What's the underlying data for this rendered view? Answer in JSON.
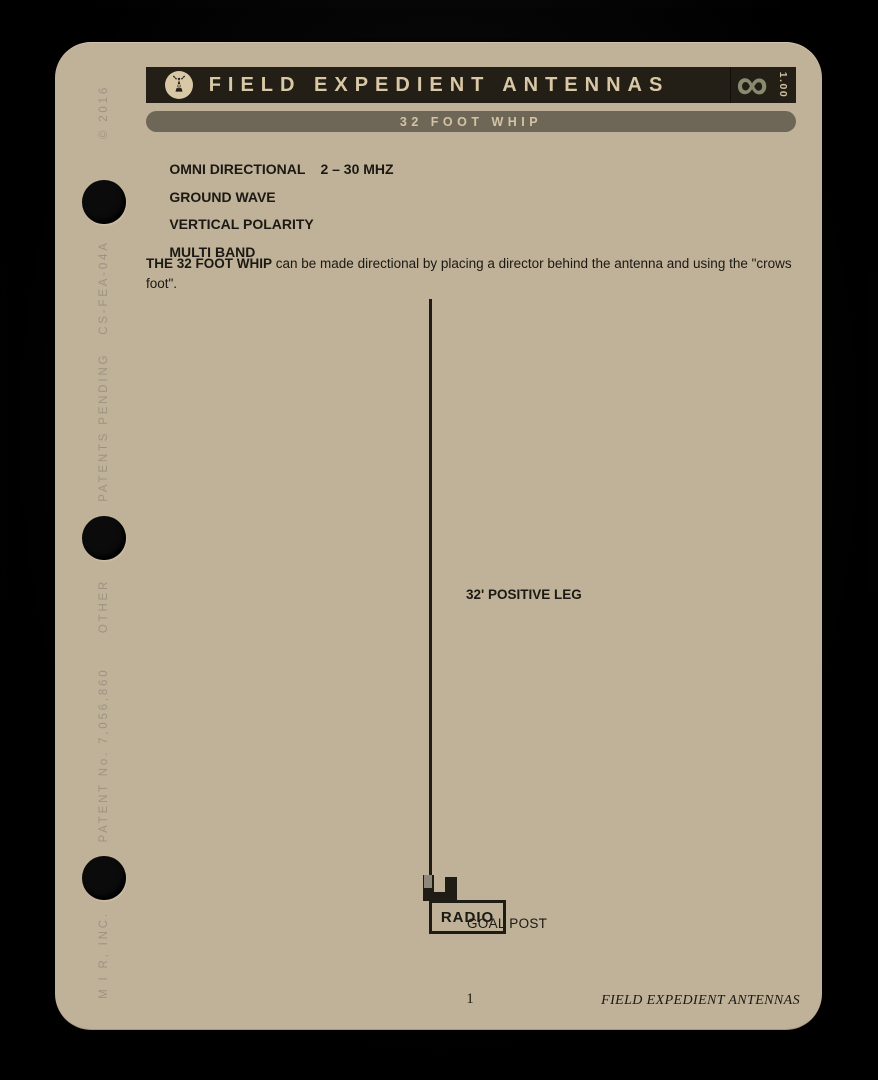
{
  "header": {
    "title": "FIELD EXPEDIENT ANTENNAS",
    "subtitle": "32 FOOT WHIP",
    "version": "1.00",
    "infinity": "∞"
  },
  "specs": [
    {
      "label": "OMNI DIRECTIONAL",
      "value": "2 – 30 MHZ"
    },
    {
      "label": "GROUND WAVE",
      "value": ""
    },
    {
      "label": "VERTICAL POLARITY",
      "value": ""
    },
    {
      "label": "MULTI BAND",
      "value": ""
    }
  ],
  "description": {
    "lead": "THE 32 FOOT WHIP",
    "body": " can be made directional by placing a director behind the antenna and using the \"crows foot\"."
  },
  "diagram": {
    "positive_leg_label": "32' POSITIVE LEG",
    "goal_post_label": "GOAL POST",
    "radio_label": "RADIO"
  },
  "spine": {
    "copyright": "© 2016",
    "patents_pending": "PATENTS PENDING   CS-FEA-04A",
    "other": "OTHER",
    "patent_number": "PATENT No. 7,056,860",
    "company": "M I R, INC."
  },
  "footer": {
    "page_number": "1",
    "book_title": "FIELD EXPEDIENT ANTENNAS"
  },
  "colors": {
    "card_background": "#c0b199",
    "header_background": "#241f16",
    "header_text": "#d8c8a6",
    "subheader_background": "#6e6657",
    "accent_olive": "#8a8a6f",
    "body_text": "#1b1913",
    "spine_text": "#9c9383",
    "hole_color": "#0b0b0b"
  }
}
